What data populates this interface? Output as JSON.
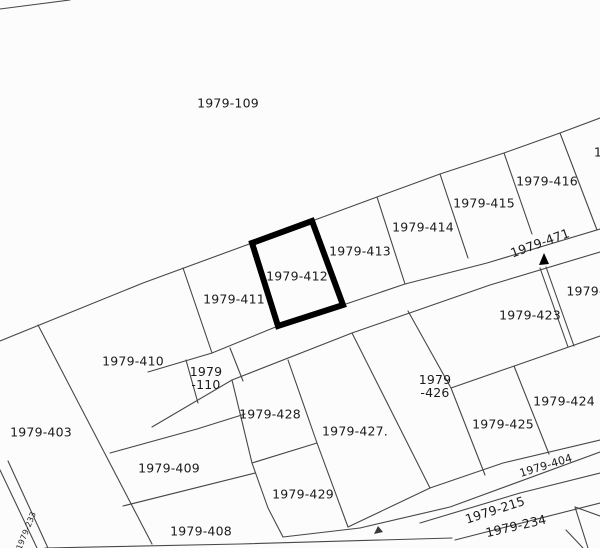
{
  "map": {
    "background_color": "#fcfcfc",
    "line_color": "#474747",
    "label_color": "#1b1b1b",
    "selected_parcel": {
      "label": "1979-412",
      "points": "252,243 312,221 343,305 278,326",
      "outline_color": "#000000"
    },
    "arrow_marker": {
      "points": "544,253 539,265 549,264",
      "color": "#000000"
    },
    "junction_tick": {
      "points": "374,534 383,532 378,526",
      "color": "#3a3a3a"
    },
    "labels": [
      {
        "name": "parcel-1979-109",
        "text": [
          "1979-109"
        ],
        "x": 228,
        "y": 103
      },
      {
        "name": "parcel-1979-416",
        "text": [
          "1979-416"
        ],
        "x": 547,
        "y": 181
      },
      {
        "name": "parcel-1979-415",
        "text": [
          "1979-415"
        ],
        "x": 484,
        "y": 203
      },
      {
        "name": "parcel-1979-414",
        "text": [
          "1979-414"
        ],
        "x": 423,
        "y": 227
      },
      {
        "name": "parcel-1979-413",
        "text": [
          "1979-413"
        ],
        "x": 360,
        "y": 251
      },
      {
        "name": "parcel-1979-412",
        "text": [
          "1979-412"
        ],
        "x": 297,
        "y": 276
      },
      {
        "name": "parcel-1979-411",
        "text": [
          "1979-411"
        ],
        "x": 234,
        "y": 299
      },
      {
        "name": "road-1979-471",
        "text": [
          "1979-471"
        ],
        "x": 540,
        "y": 243,
        "rot": -20
      },
      {
        "name": "partial-label-top-right",
        "text": [
          "1"
        ],
        "x": 598,
        "y": 152
      },
      {
        "name": "partial-label-right",
        "text": [
          "1979-"
        ],
        "x": 585,
        "y": 291
      },
      {
        "name": "parcel-1979-423",
        "text": [
          "1979-423"
        ],
        "x": 530,
        "y": 315
      },
      {
        "name": "parcel-1979-410",
        "text": [
          "1979-410"
        ],
        "x": 133,
        "y": 361
      },
      {
        "name": "parcel-1979-110",
        "text": [
          "1979",
          "-110"
        ],
        "x": 206,
        "y": 378
      },
      {
        "name": "parcel-1979-426",
        "text": [
          "1979",
          "-426"
        ],
        "x": 435,
        "y": 386
      },
      {
        "name": "parcel-1979-424",
        "text": [
          "1979-424"
        ],
        "x": 564,
        "y": 401
      },
      {
        "name": "parcel-1979-428",
        "text": [
          "1979-428"
        ],
        "x": 270,
        "y": 414
      },
      {
        "name": "parcel-1979-425",
        "text": [
          "1979-425"
        ],
        "x": 503,
        "y": 424
      },
      {
        "name": "parcel-1979-427",
        "text": [
          "1979-427."
        ],
        "x": 355,
        "y": 431
      },
      {
        "name": "parcel-1979-403",
        "text": [
          "1979-403"
        ],
        "x": 41,
        "y": 432
      },
      {
        "name": "road-1979-404",
        "text": [
          "1979-404"
        ],
        "x": 546,
        "y": 466,
        "rot": -17,
        "fs": 11
      },
      {
        "name": "parcel-1979-409",
        "text": [
          "1979-409"
        ],
        "x": 169,
        "y": 468
      },
      {
        "name": "parcel-1979-429",
        "text": [
          "1979-429"
        ],
        "x": 303,
        "y": 494
      },
      {
        "name": "road-1979-215",
        "text": [
          "1979-215"
        ],
        "x": 495,
        "y": 510,
        "rot": -18
      },
      {
        "name": "road-1979-234",
        "text": [
          "1979-234"
        ],
        "x": 516,
        "y": 526,
        "rot": -13
      },
      {
        "name": "parcel-1979-408",
        "text": [
          "1979-408"
        ],
        "x": 201,
        "y": 531
      },
      {
        "name": "road-1979-233",
        "text": [
          "1979-233"
        ],
        "x": 27,
        "y": 531,
        "rot": -68,
        "fs": 8
      }
    ]
  }
}
